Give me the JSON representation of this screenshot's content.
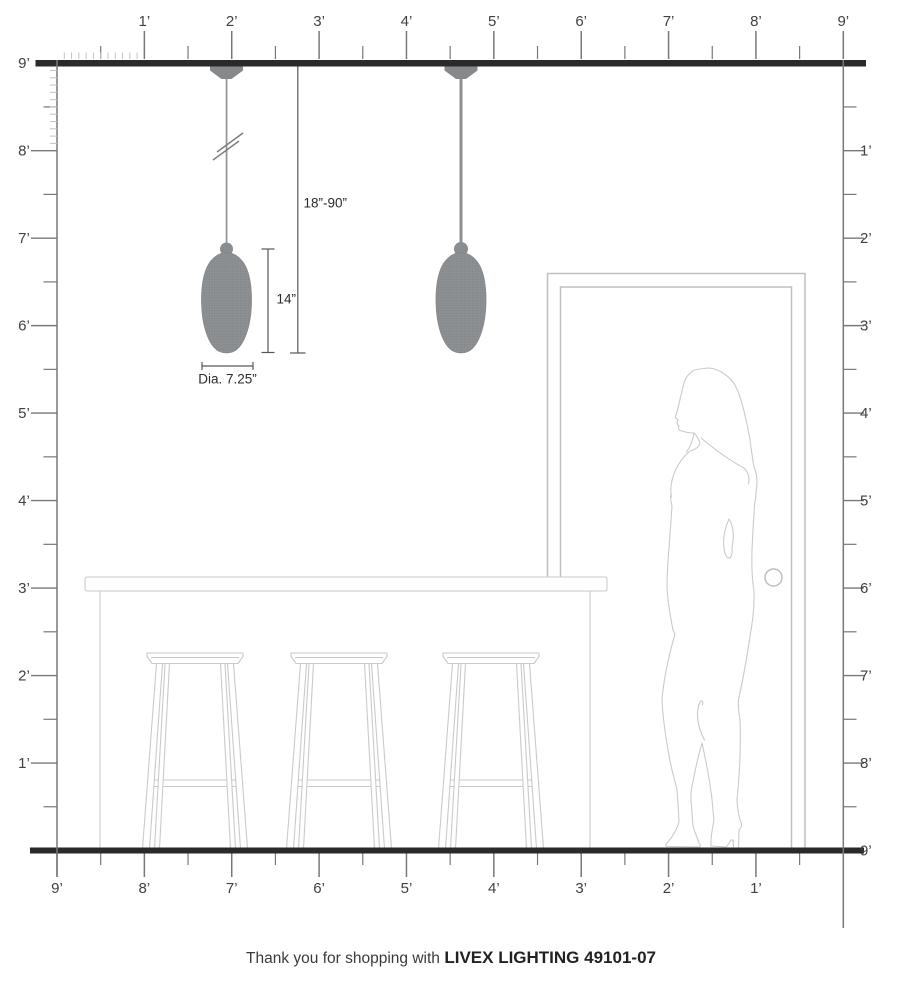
{
  "rulers": {
    "top": {
      "labels": [
        "1’",
        "2’",
        "3’",
        "4’",
        "5’",
        "6’",
        "7’",
        "8’",
        "9’"
      ]
    },
    "left": {
      "labels": [
        "9’",
        "8’",
        "7’",
        "6’",
        "5’",
        "4’",
        "3’",
        "2’",
        "1’"
      ]
    },
    "right": {
      "labels": [
        "1’",
        "2’",
        "3’",
        "4’",
        "5’",
        "6’",
        "7’",
        "8’",
        "9’"
      ]
    },
    "bottom": {
      "labels": [
        "9’",
        "8’",
        "7’",
        "6’",
        "5’",
        "4’",
        "3’",
        "2’",
        "1’"
      ]
    }
  },
  "dimensions": {
    "hanging_range": "18”-90”",
    "shade_height": "14”",
    "shade_diameter": "Dia. 7.25”"
  },
  "footer": {
    "prefix": "Thank you for shopping with",
    "brand": "LIVEX LIGHTING 49101-07"
  },
  "colors": {
    "wall": "#2a2a2c",
    "ruler": "#77787b",
    "minor": "#c2c3c5",
    "label": "#414143",
    "fixture": "#8d9093",
    "outline": "#c9cacc",
    "door": "#bdbfc1",
    "dim": "#56575a"
  }
}
